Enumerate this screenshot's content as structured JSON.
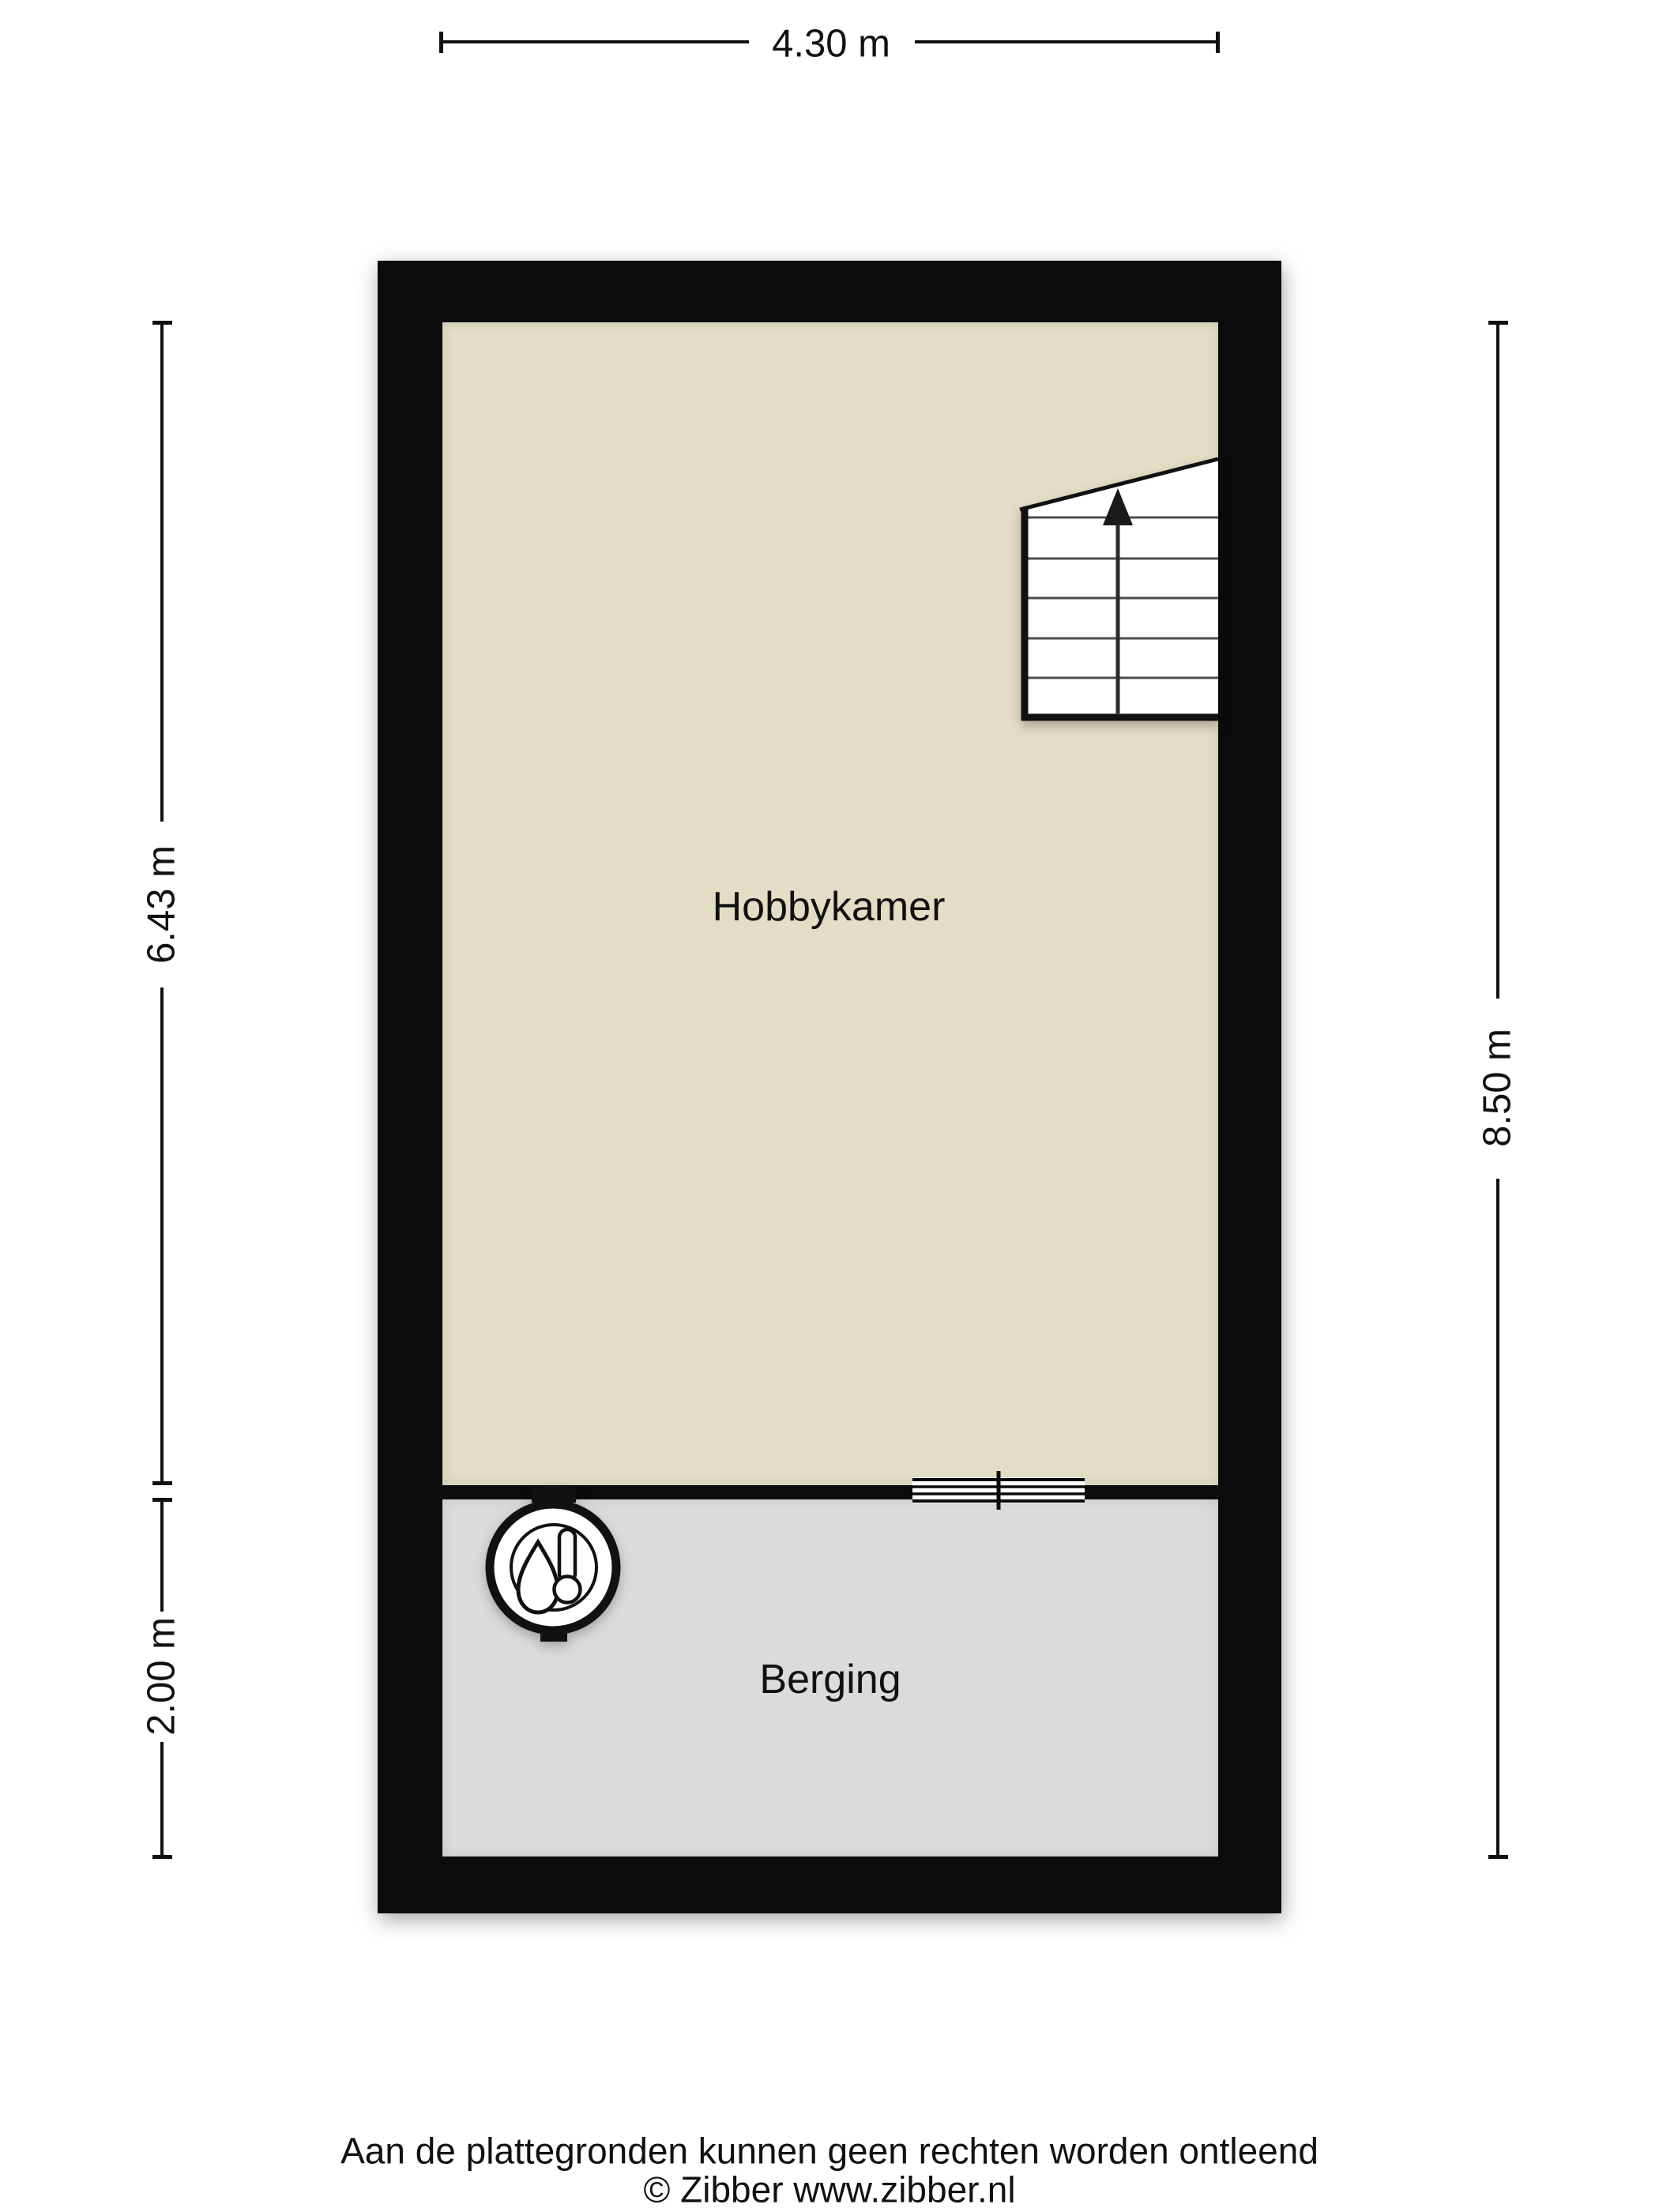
{
  "dimensions": {
    "width_top": "4.30 m",
    "hobbykamer_height": "6.43 m",
    "berging_height": "2.00 m",
    "total_height_right": "8.50 m"
  },
  "rooms": {
    "hobbykamer": {
      "label": "Hobbykamer"
    },
    "berging": {
      "label": "Berging"
    }
  },
  "icons": {
    "boiler": "boiler-icon",
    "stair_arrow": "up-arrow-icon",
    "door": "door-opening-icon"
  },
  "footer": {
    "disclaimer": "Aan de plattegronden kunnen geen rechten worden ontleend",
    "copyright": "© Zibber www.zibber.nl"
  },
  "colors": {
    "wall": "#0b0b0b",
    "hobbykamer_floor": "#e4ddc5",
    "berging_floor": "#dbdbdb",
    "ink": "#111111",
    "background": "#ffffff"
  }
}
